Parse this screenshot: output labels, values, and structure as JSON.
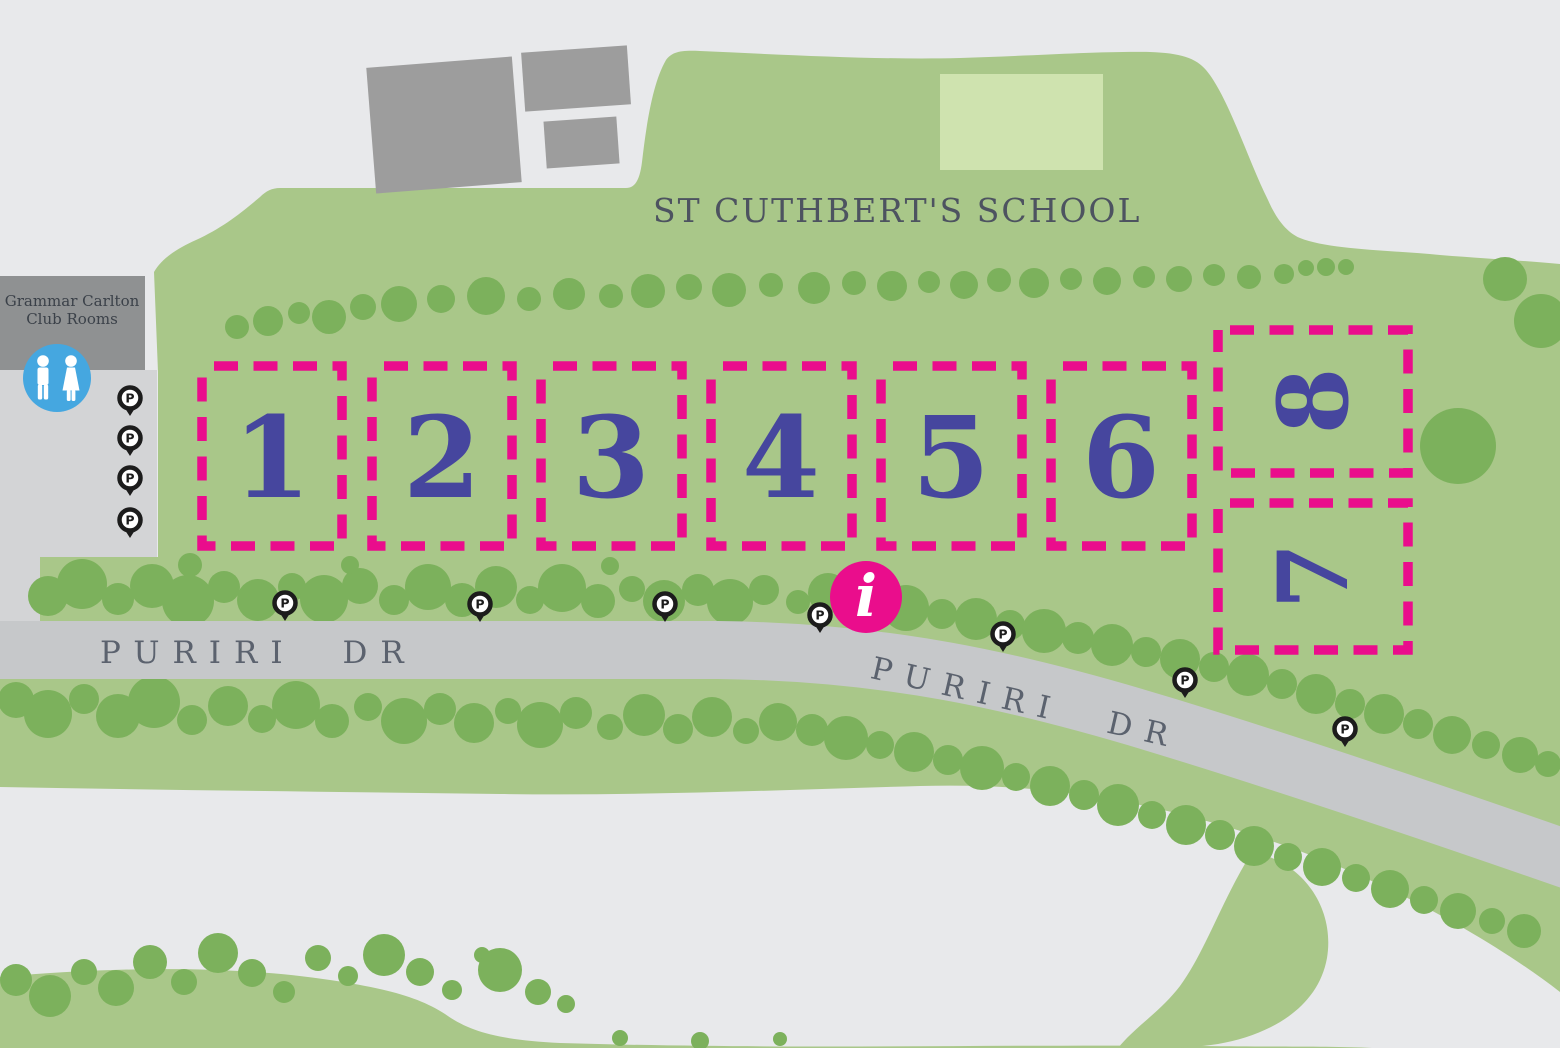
{
  "map": {
    "title_school": "ST CUTHBERT'S SCHOOL",
    "club_rooms": {
      "line1": "Grammar Carlton",
      "line2": "Club Rooms"
    },
    "roads": {
      "puriri_left": "PURIRI DR",
      "puriri_right": "PURIRI DR"
    },
    "markers": {
      "parking_label": "P",
      "info_label": "i"
    },
    "zones": [
      {
        "id": "1",
        "label": "1"
      },
      {
        "id": "2",
        "label": "2"
      },
      {
        "id": "3",
        "label": "3"
      },
      {
        "id": "4",
        "label": "4"
      },
      {
        "id": "5",
        "label": "5"
      },
      {
        "id": "6",
        "label": "6"
      },
      {
        "id": "7",
        "label": "7"
      },
      {
        "id": "8",
        "label": "8"
      }
    ],
    "colors": {
      "background": "#e8e9eb",
      "park_green": "#a9c789",
      "tree_green": "#7cb15c",
      "field_green": "#cfe3af",
      "building_gray": "#9d9d9d",
      "club_gray": "#8f9192",
      "parking_gray": "#d3d4d6",
      "road_gray": "#c6c8ca",
      "road_text": "#5b626e",
      "school_text": "#4d5360",
      "zone_pink": "#ea0d8c",
      "zone_number_blue": "#46469e",
      "toilet_blue": "#45a7e0",
      "pin_black": "#1c1c1c",
      "club_text": "#3b4149"
    }
  }
}
